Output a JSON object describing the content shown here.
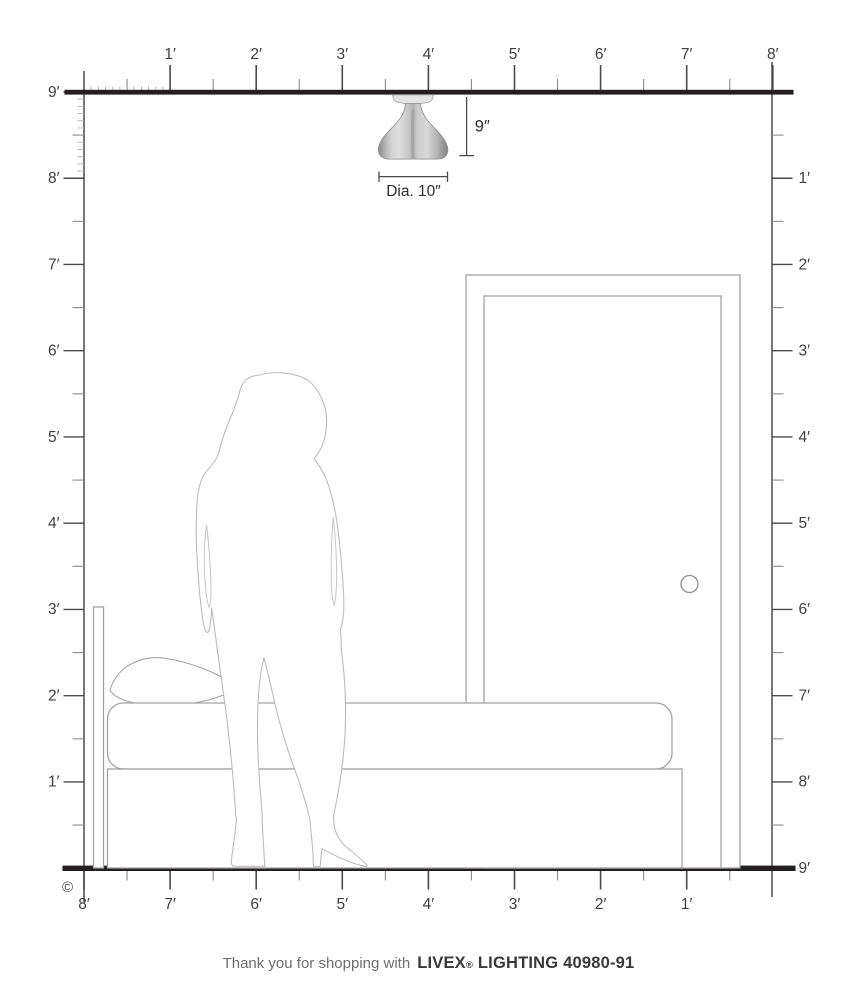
{
  "rulers": {
    "top": {
      "labels": [
        "1′",
        "2′",
        "3′",
        "4′",
        "5′",
        "6′",
        "7′",
        "8′"
      ]
    },
    "left": {
      "labels": [
        "9′",
        "8′",
        "7′",
        "6′",
        "5′",
        "4′",
        "3′",
        "2′",
        "1′"
      ]
    },
    "right": {
      "labels": [
        "1′",
        "2′",
        "3′",
        "4′",
        "5′",
        "6′",
        "7′",
        "8′",
        "9′"
      ]
    },
    "bottom": {
      "labels": [
        "8′",
        "7′",
        "6′",
        "5′",
        "4′",
        "3′",
        "2′",
        "1′"
      ]
    }
  },
  "fixture": {
    "height_label": "9″",
    "diameter_label": "Dia. 10″"
  },
  "footer": {
    "prefix": "Thank you for shopping with",
    "brand": "LIVEX",
    "registered_mark": "®",
    "suffix": "LIGHTING 40980-91"
  },
  "copyright_symbol": "©",
  "colors": {
    "wall_line": "#231f20",
    "ruler": "#4a4a4a",
    "tick_half": "#8d8d8d",
    "tick_inch": "#b2b2b2",
    "label": "#3f3f3f",
    "outline_gray": "#a3a3a3",
    "silhouette_gray": "#bcbcbc",
    "nickel_dark": "#868686",
    "nickel_light": "#dedede"
  }
}
